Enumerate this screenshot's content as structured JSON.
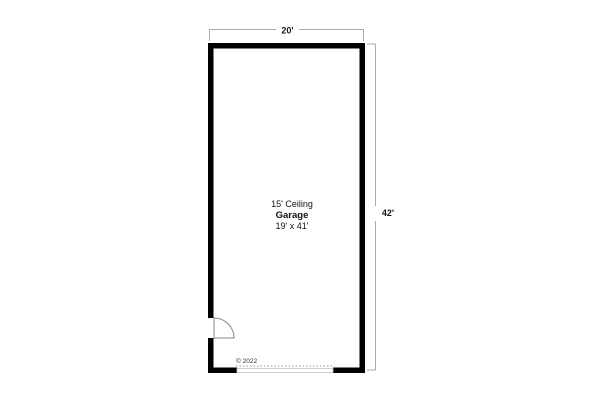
{
  "plan": {
    "room": {
      "ceiling_label": "15' Ceiling",
      "name": "Garage",
      "size_label": "19' x 41'"
    },
    "dimensions": {
      "width_label": "20'",
      "height_label": "42'"
    },
    "copyright": "© 2022",
    "features": {
      "door": "swing-door-lower-left",
      "garage_door_opening": "dashed-opening-bottom-wall"
    },
    "colors": {
      "wall": "#000000",
      "dimension_line": "#aaaaaa",
      "door_outline": "#8a8a8a",
      "dashed_opening": "#999999",
      "opening_outline": "#c4c4c4",
      "background": "#ffffff",
      "text": "#111111"
    }
  }
}
